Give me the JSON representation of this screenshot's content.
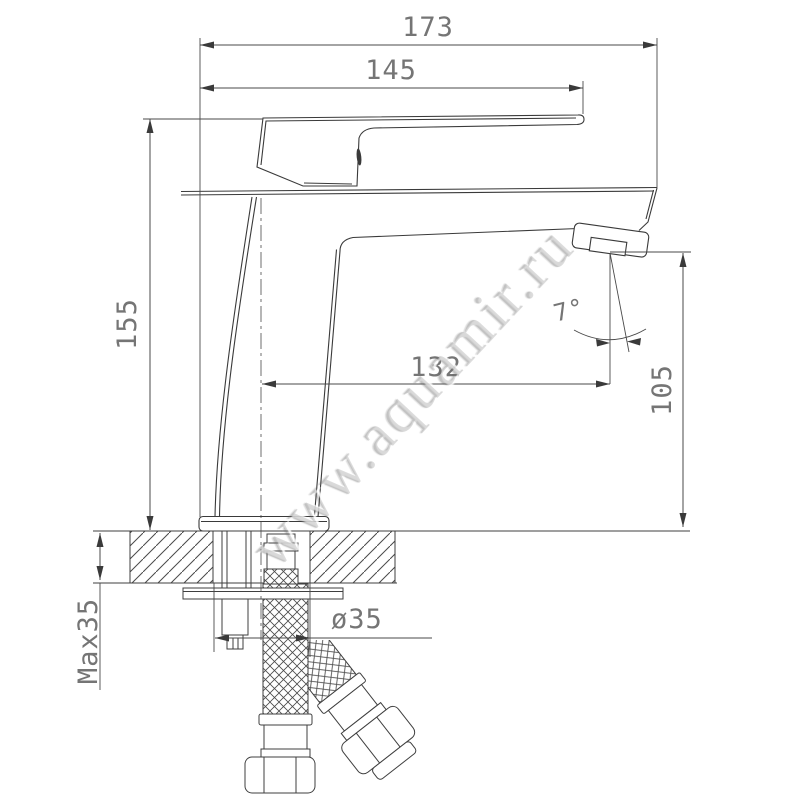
{
  "drawing": {
    "watermark": "www.aquamir.ru",
    "dimensions": {
      "overall_length": "173",
      "handle_length": "145",
      "total_height": "155",
      "spout_reach": "132",
      "outlet_height": "105",
      "stream_angle": "7°",
      "hole_diameter": "ø35",
      "max_deck_thickness": "Max35"
    }
  }
}
